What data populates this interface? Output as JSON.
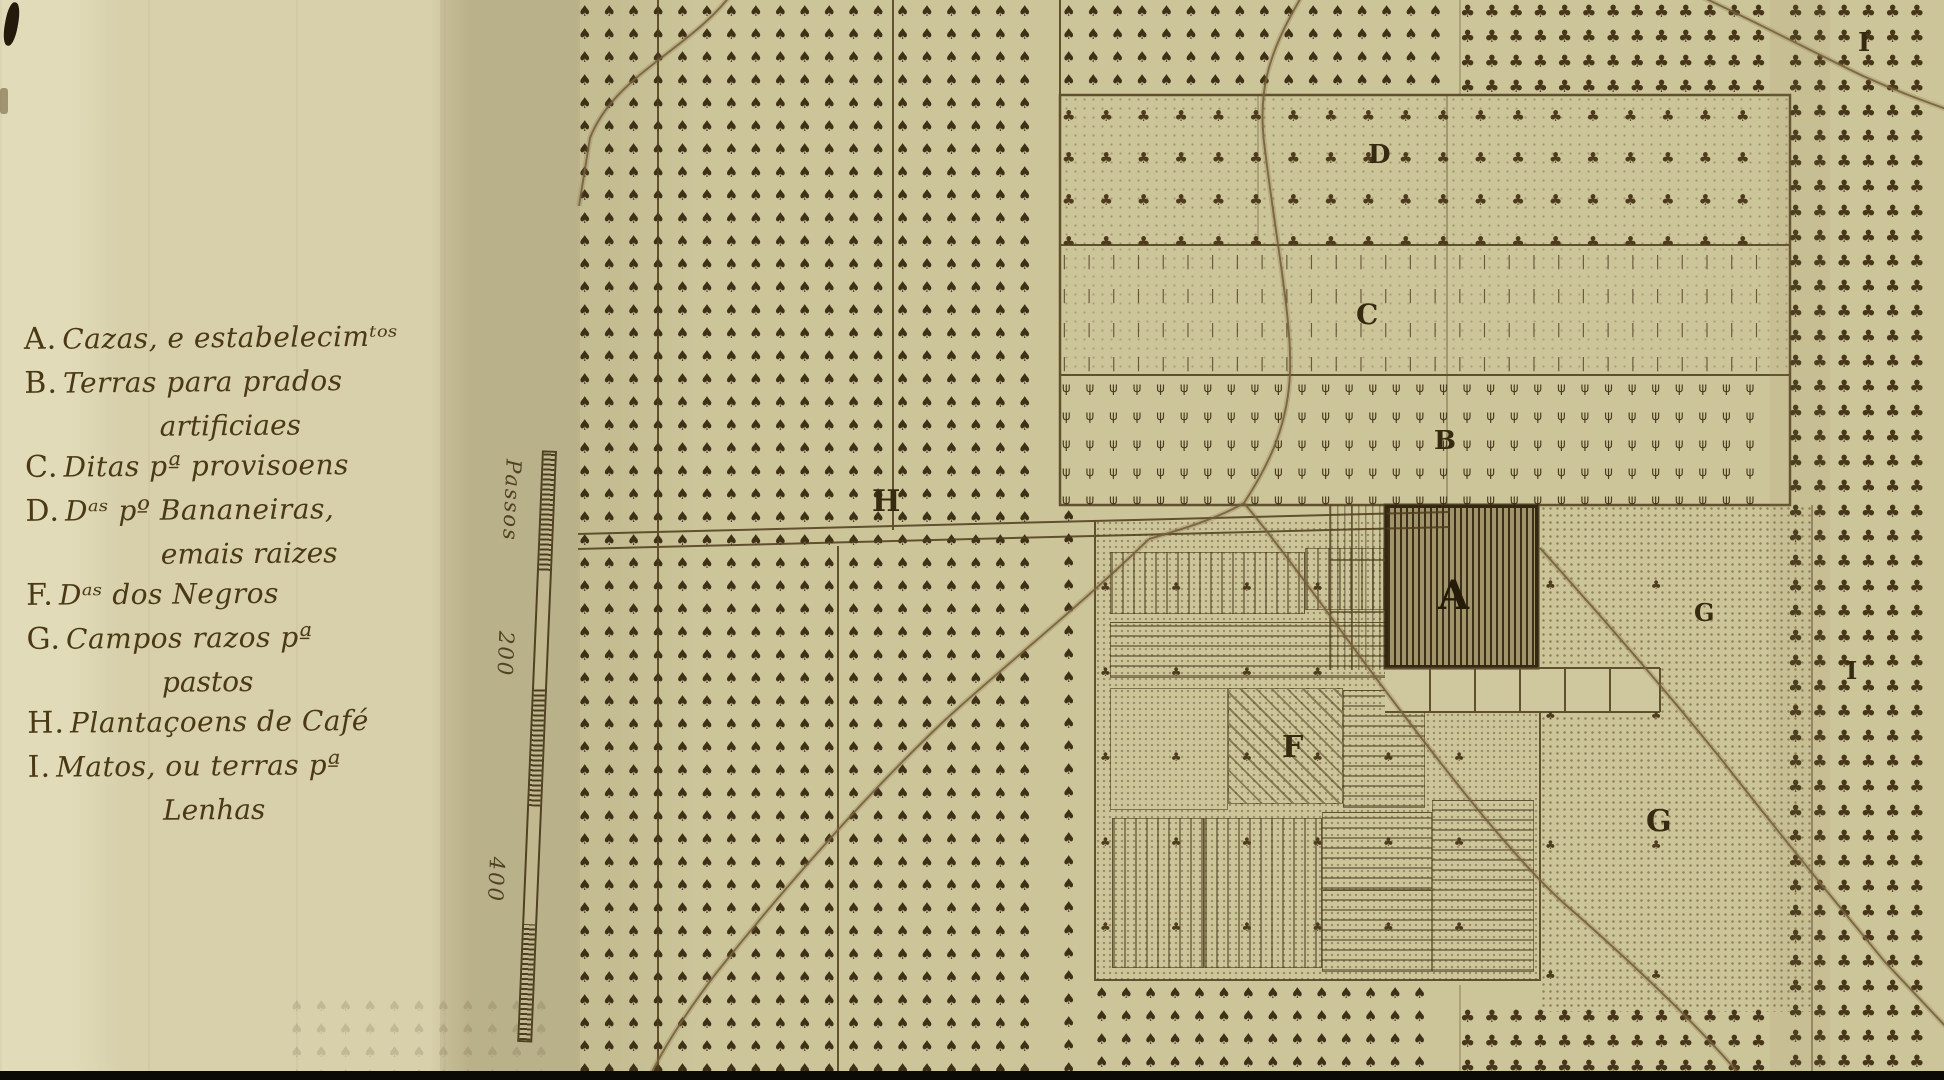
{
  "document": {
    "type": "historic-plantation-plan-map",
    "language": "Portuguese"
  },
  "legend": {
    "entries": [
      {
        "key": "A.",
        "text": "Cazas, e estabelecimᵗᵒˢ",
        "text2": ""
      },
      {
        "key": "B.",
        "text": "Terras para prados",
        "text2": "artificiaes"
      },
      {
        "key": "C.",
        "text": "Ditas pª provisoens",
        "text2": ""
      },
      {
        "key": "D.",
        "text": "Dᵃˢ pº Bananeiras,",
        "text2": "emais raizes"
      },
      {
        "key": "F.",
        "text": "Dᵃˢ dos Negros",
        "text2": ""
      },
      {
        "key": "G.",
        "text": "Campos razos pª",
        "text2": "pastos"
      },
      {
        "key": "H.",
        "text": "Plantaçoens de Café",
        "text2": ""
      },
      {
        "key": "I.",
        "text": "Matos, ou terras pª",
        "text2": "Lenhas"
      }
    ]
  },
  "scale": {
    "unit_label": "Passos",
    "tick_200": "200",
    "tick_400": "400"
  },
  "map": {
    "labels": {
      "a": "A",
      "b": "B",
      "c": "C",
      "d": "D",
      "f": "F",
      "g_small": "G",
      "g_large": "G",
      "h": "H",
      "i_top": "I",
      "i_mid": "I"
    }
  },
  "colors": {
    "paper": "#cdc59a",
    "paper_margin": "#d7d0ab",
    "ink": "#46351a",
    "road": "#76603a"
  }
}
